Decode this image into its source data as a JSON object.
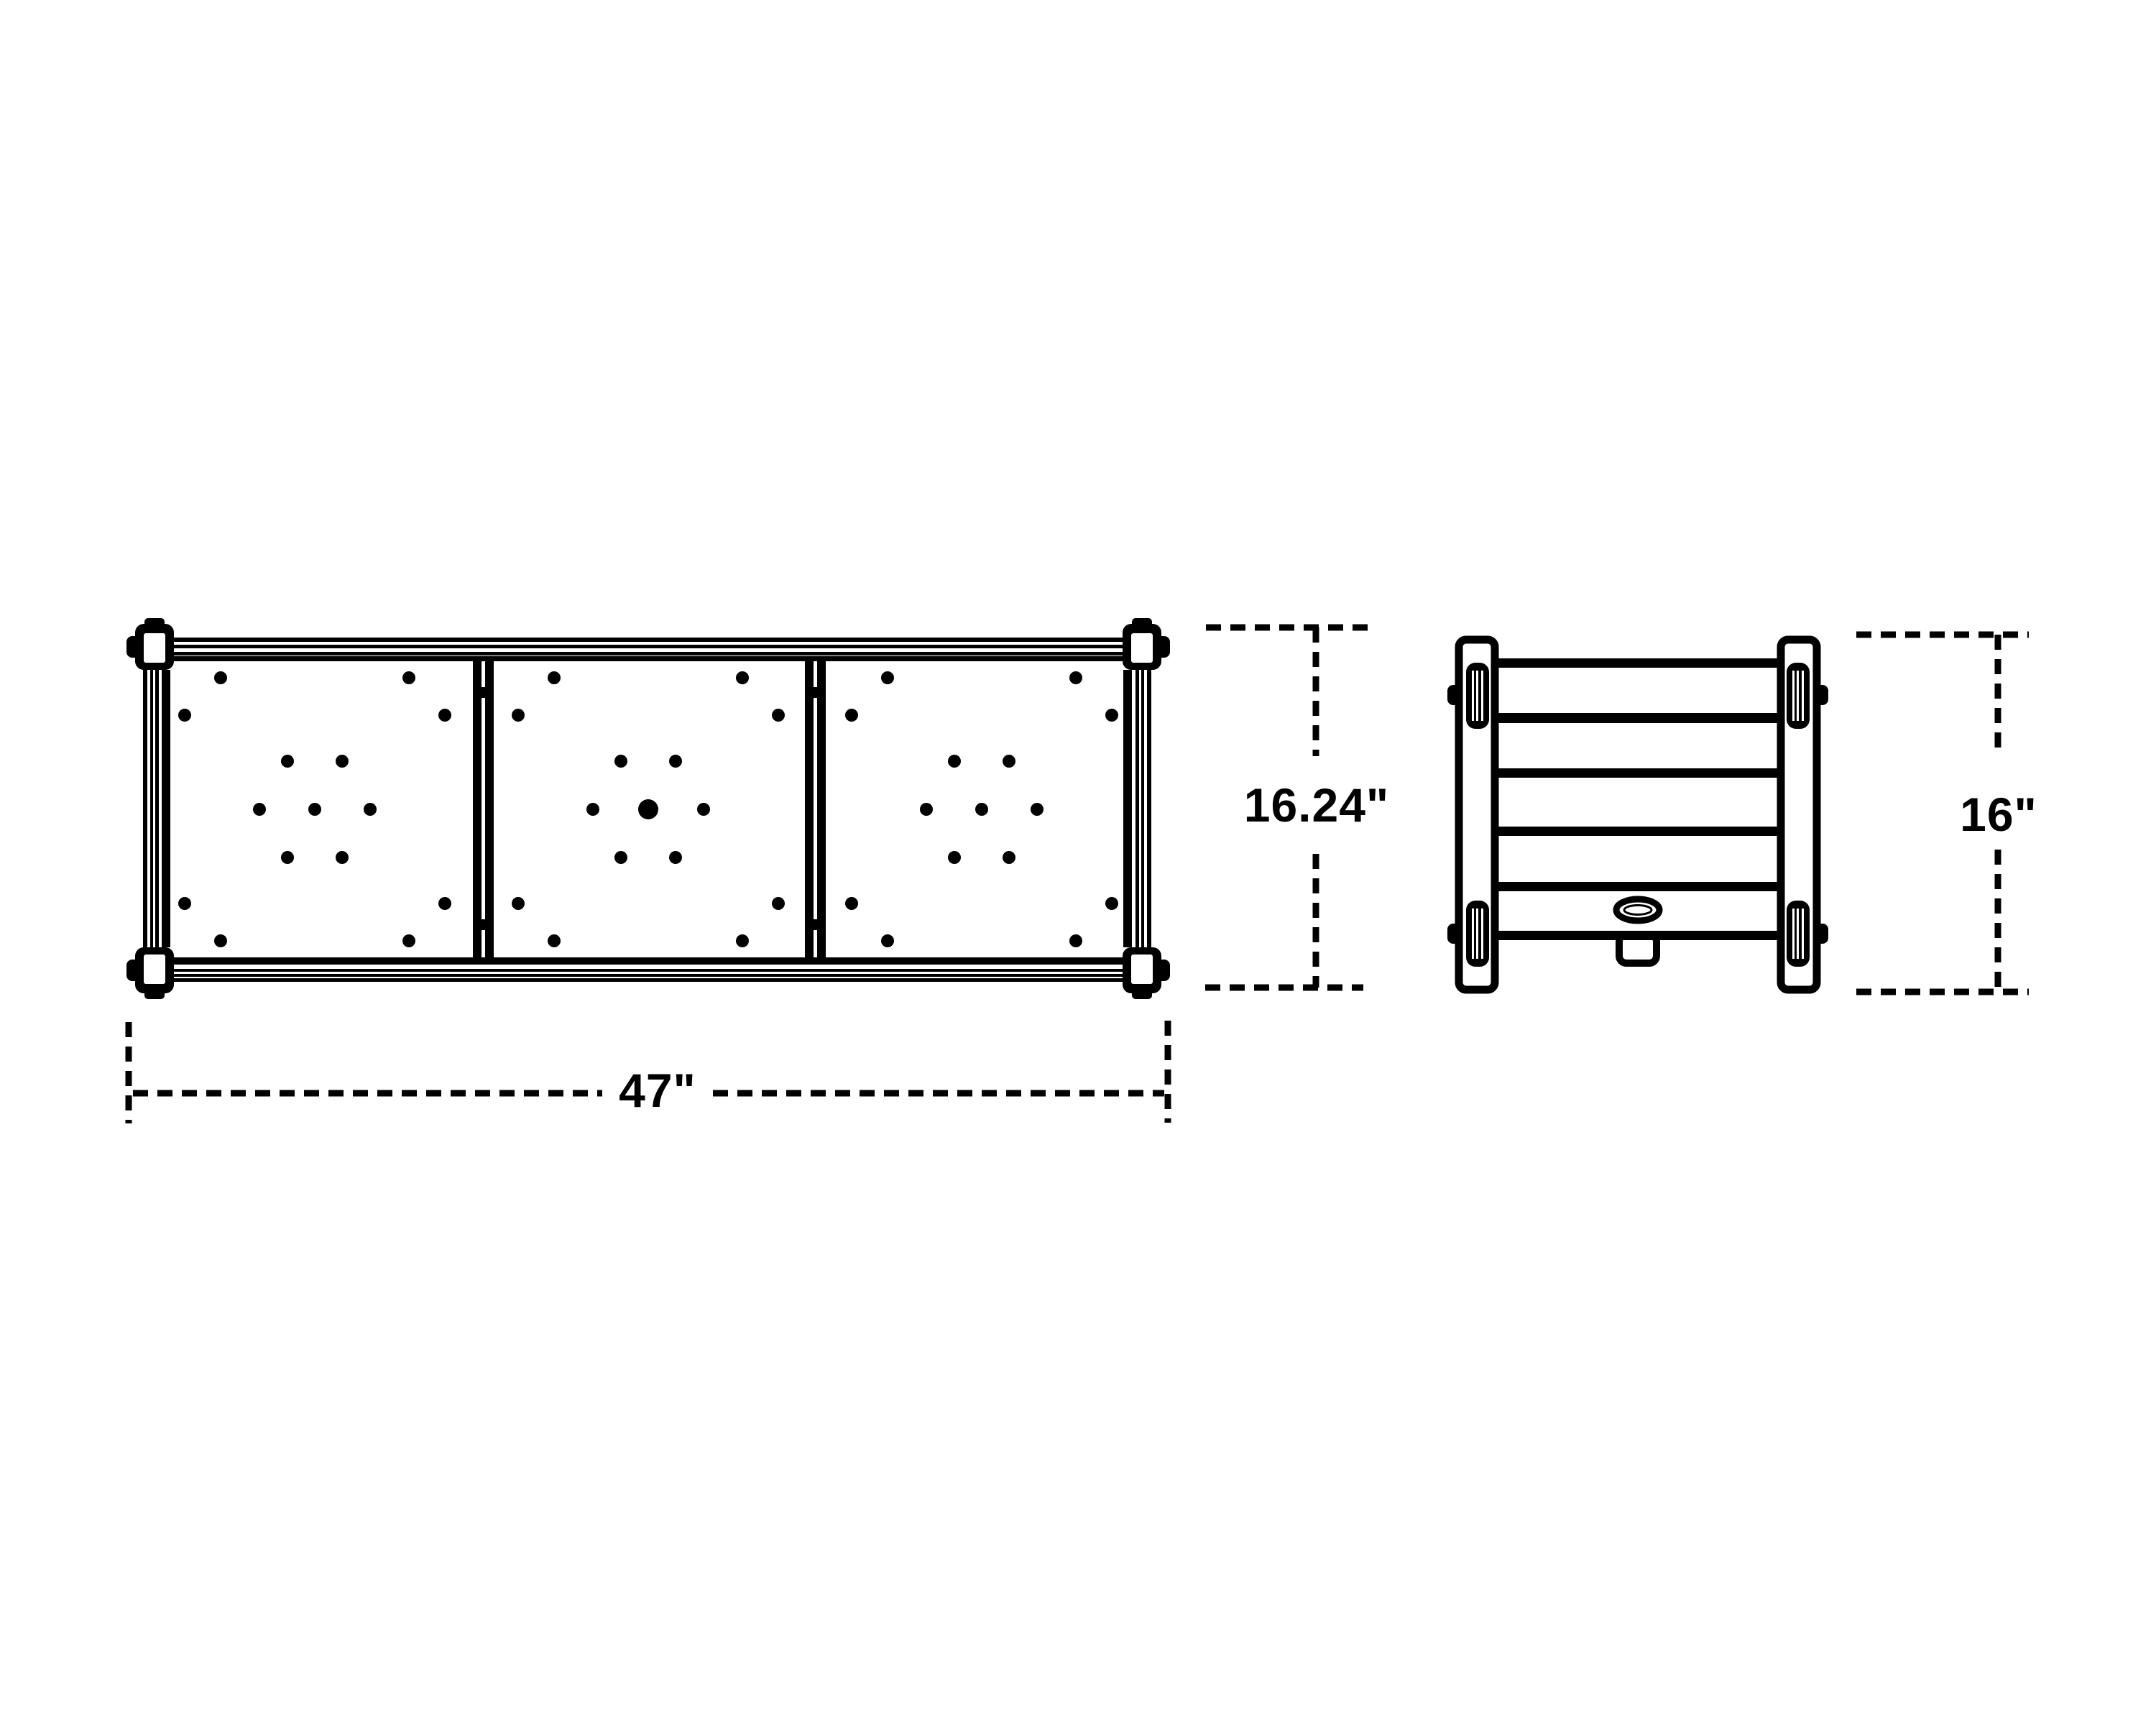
{
  "canvas": {
    "background": "#ffffff",
    "ink": "#000000"
  },
  "views": {
    "top": {
      "name": "top-view",
      "panel_count": 3,
      "divider_count": 2,
      "holes_per_panel": 15,
      "corner_blocks": 4
    },
    "end": {
      "name": "end-view",
      "slat_count": 6,
      "leg_count": 2,
      "foot_pads_per_leg": 2
    }
  },
  "dimensions": {
    "width": {
      "label": "47\""
    },
    "depth": {
      "label": "16.24\""
    },
    "height": {
      "label": "16\""
    }
  }
}
